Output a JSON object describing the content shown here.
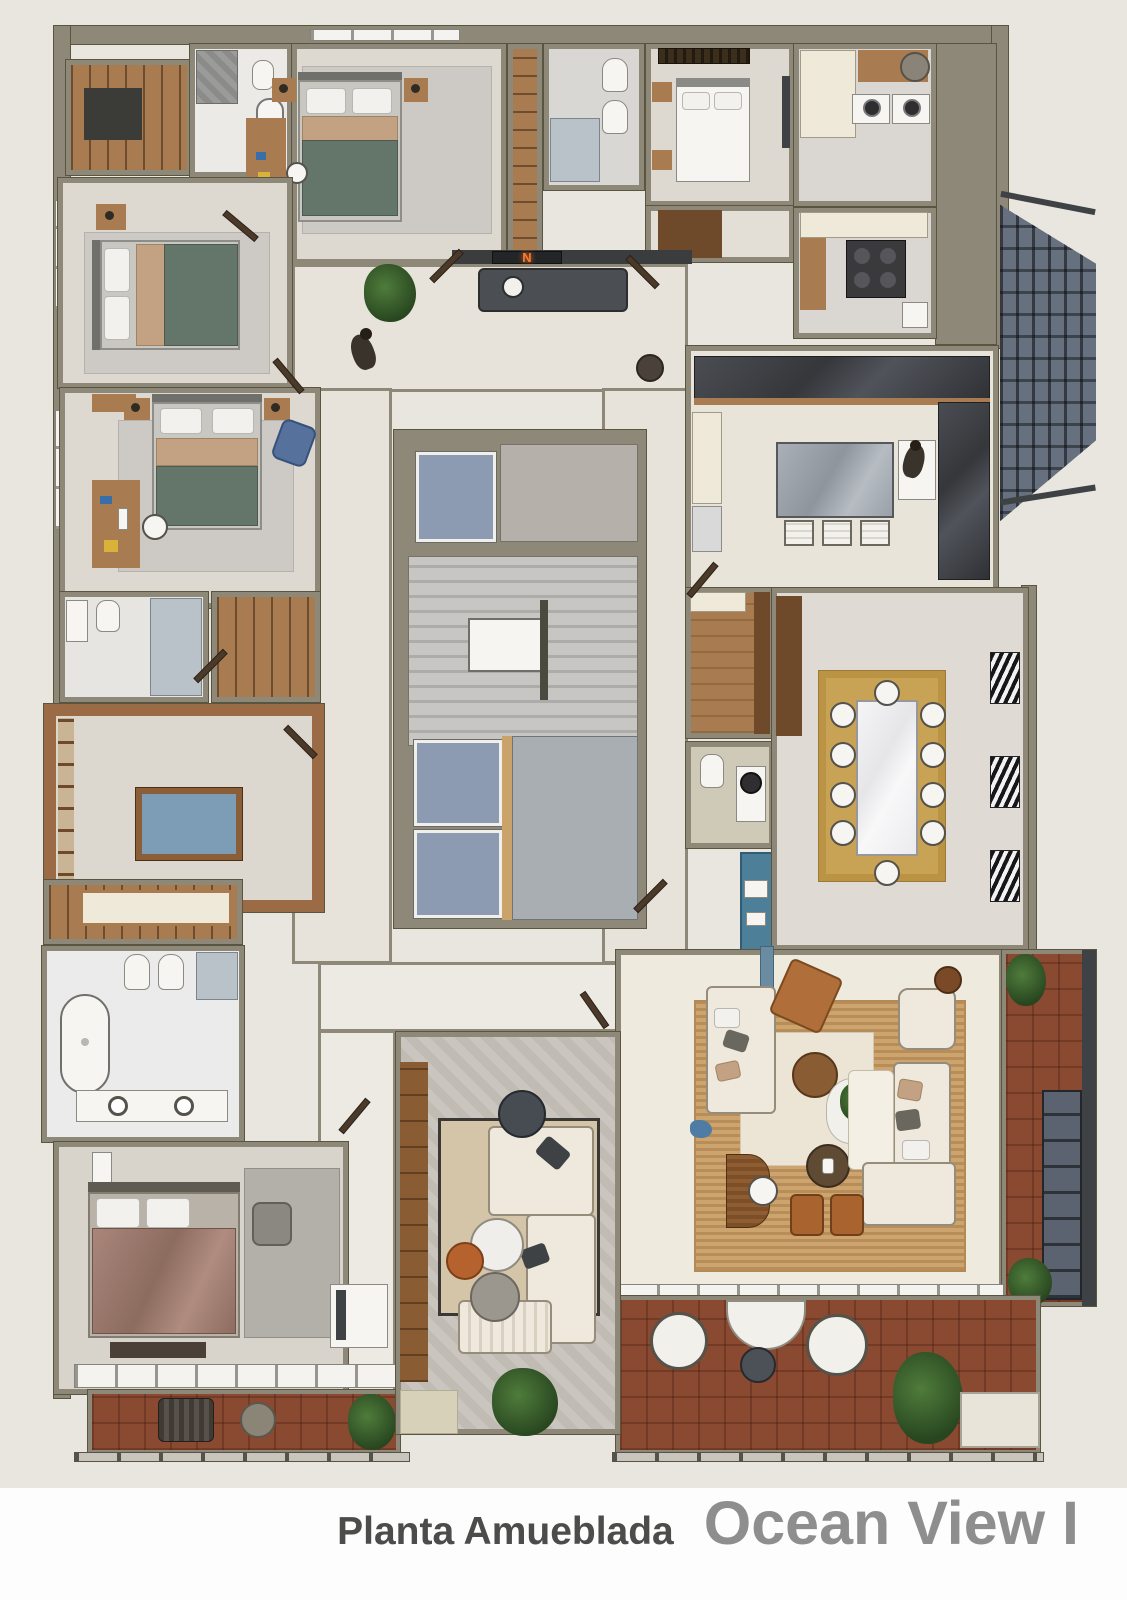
{
  "caption": {
    "label": "Planta Amueblada",
    "title": "Ocean View I"
  },
  "entry_sign": {
    "letter": "N",
    "glow_color": "#ff7a2a"
  },
  "palette": {
    "page_background": "#e9e6e0",
    "caption_background": "#fdfdfd",
    "wall": "#8d8877",
    "floor_beige": "#ded9d0",
    "carpet_gray": "#cdc9c4",
    "wood_light": "#a87c50",
    "wood_dark": "#6e4a2a",
    "sage_quilt": "#64756a",
    "tan_throw": "#c2a283",
    "mauve_quilt": "#9d7b6f",
    "terracotta_tile": "#8a4a31",
    "gold_rug": "#c9a355",
    "jute_rug": "#cda36e",
    "elevator_cab": "#8c9bb2",
    "dark_counter": "#3a3d41",
    "pool_felt": "#7d9cb5",
    "fire_escape_steel": "#3a3f45"
  },
  "people_visible": 2,
  "rooms": [
    {
      "name": "guest-bedroom-top",
      "furniture": [
        "double-bed-sage-quilt",
        "nightstands-with-lamps",
        "desk",
        "gray-rug"
      ]
    },
    {
      "name": "guest-bathroom-top-left",
      "furniture": [
        "shower",
        "toilet",
        "bathtub"
      ]
    },
    {
      "name": "entry-closet-top-left",
      "furniture": [
        "wardrobe"
      ]
    },
    {
      "name": "guest-bedroom-left-upper",
      "furniture": [
        "double-bed-sage-quilt",
        "nightstand",
        "gray-rug"
      ]
    },
    {
      "name": "guest-bedroom-left-lower",
      "furniture": [
        "double-bed-sage-quilt",
        "desk",
        "desk-chair",
        "blue-lounge-chair",
        "gray-rug"
      ]
    },
    {
      "name": "guest-bathroom-left",
      "furniture": [
        "toilet",
        "vanity",
        "glass-shower"
      ]
    },
    {
      "name": "games-room",
      "furniture": [
        "billiard-table",
        "wood-paneling",
        "shelving"
      ]
    },
    {
      "name": "walk-in-closet",
      "furniture": [
        "shelving",
        "island-dresser"
      ]
    },
    {
      "name": "master-bathroom",
      "furniture": [
        "freestanding-tub",
        "toilet",
        "bidet",
        "double-vanity",
        "glass-shower"
      ]
    },
    {
      "name": "master-bedroom",
      "furniture": [
        "king-bed-mauve-quilt",
        "bench",
        "armchair",
        "tv-cabinet",
        "gray-rug"
      ]
    },
    {
      "name": "master-terrace",
      "furniture": [
        "lounge-chair",
        "round-table",
        "plant"
      ]
    },
    {
      "name": "entry-hall",
      "furniture": [
        "media-console",
        "illuminated-sign",
        "potted-plant",
        "stool"
      ]
    },
    {
      "name": "elevator-core",
      "furniture": [
        "elevator-cab",
        "elevator-cab",
        "elevator-cab",
        "staircase",
        "landing"
      ]
    },
    {
      "name": "service-bathroom",
      "furniture": [
        "toilet",
        "bidet",
        "glass-shower"
      ]
    },
    {
      "name": "service-bedroom",
      "furniture": [
        "single-bed",
        "nightstands",
        "tv-panel",
        "dark-blinds"
      ]
    },
    {
      "name": "laundry-room",
      "furniture": [
        "washer",
        "dryer",
        "water-heater",
        "counter"
      ]
    },
    {
      "name": "service-kitchen",
      "furniture": [
        "stove",
        "counter",
        "sink"
      ]
    },
    {
      "name": "kitchen",
      "furniture": [
        "dark-marble-counters",
        "island-with-3-stools",
        "fridge",
        "sink"
      ]
    },
    {
      "name": "pantry-hall",
      "furniture": [
        "wood-floor",
        "wardrobe"
      ]
    },
    {
      "name": "powder-room",
      "furniture": [
        "toilet",
        "vanity",
        "round-mirror"
      ]
    },
    {
      "name": "coffee-bar",
      "furniture": [
        "espresso-machine",
        "blue-cabinet"
      ]
    },
    {
      "name": "dining-room",
      "furniture": [
        "marble-table",
        "ten-chairs",
        "gold-rug",
        "striped-blinds",
        "wardrobe"
      ]
    },
    {
      "name": "living-room",
      "furniture": [
        "two-sofas",
        "armchair",
        "leather-chair",
        "coffee-tables",
        "plant-table",
        "leather-ottomans",
        "desk",
        "jute-rug"
      ]
    },
    {
      "name": "living-balcony",
      "furniture": [
        "plants",
        "glazed-wall"
      ]
    },
    {
      "name": "family-tv-room",
      "furniture": [
        "sectional-sofa",
        "round-coffee-tables",
        "ottoman",
        "wood-wall-unit",
        "plant",
        "rug"
      ]
    },
    {
      "name": "south-terrace",
      "furniture": [
        "curved-sofa",
        "two-round-lounge-chairs",
        "side-table",
        "plants",
        "planter-box"
      ]
    },
    {
      "name": "fire-escape-stair",
      "furniture": [
        "steel-glass-structure"
      ]
    }
  ]
}
